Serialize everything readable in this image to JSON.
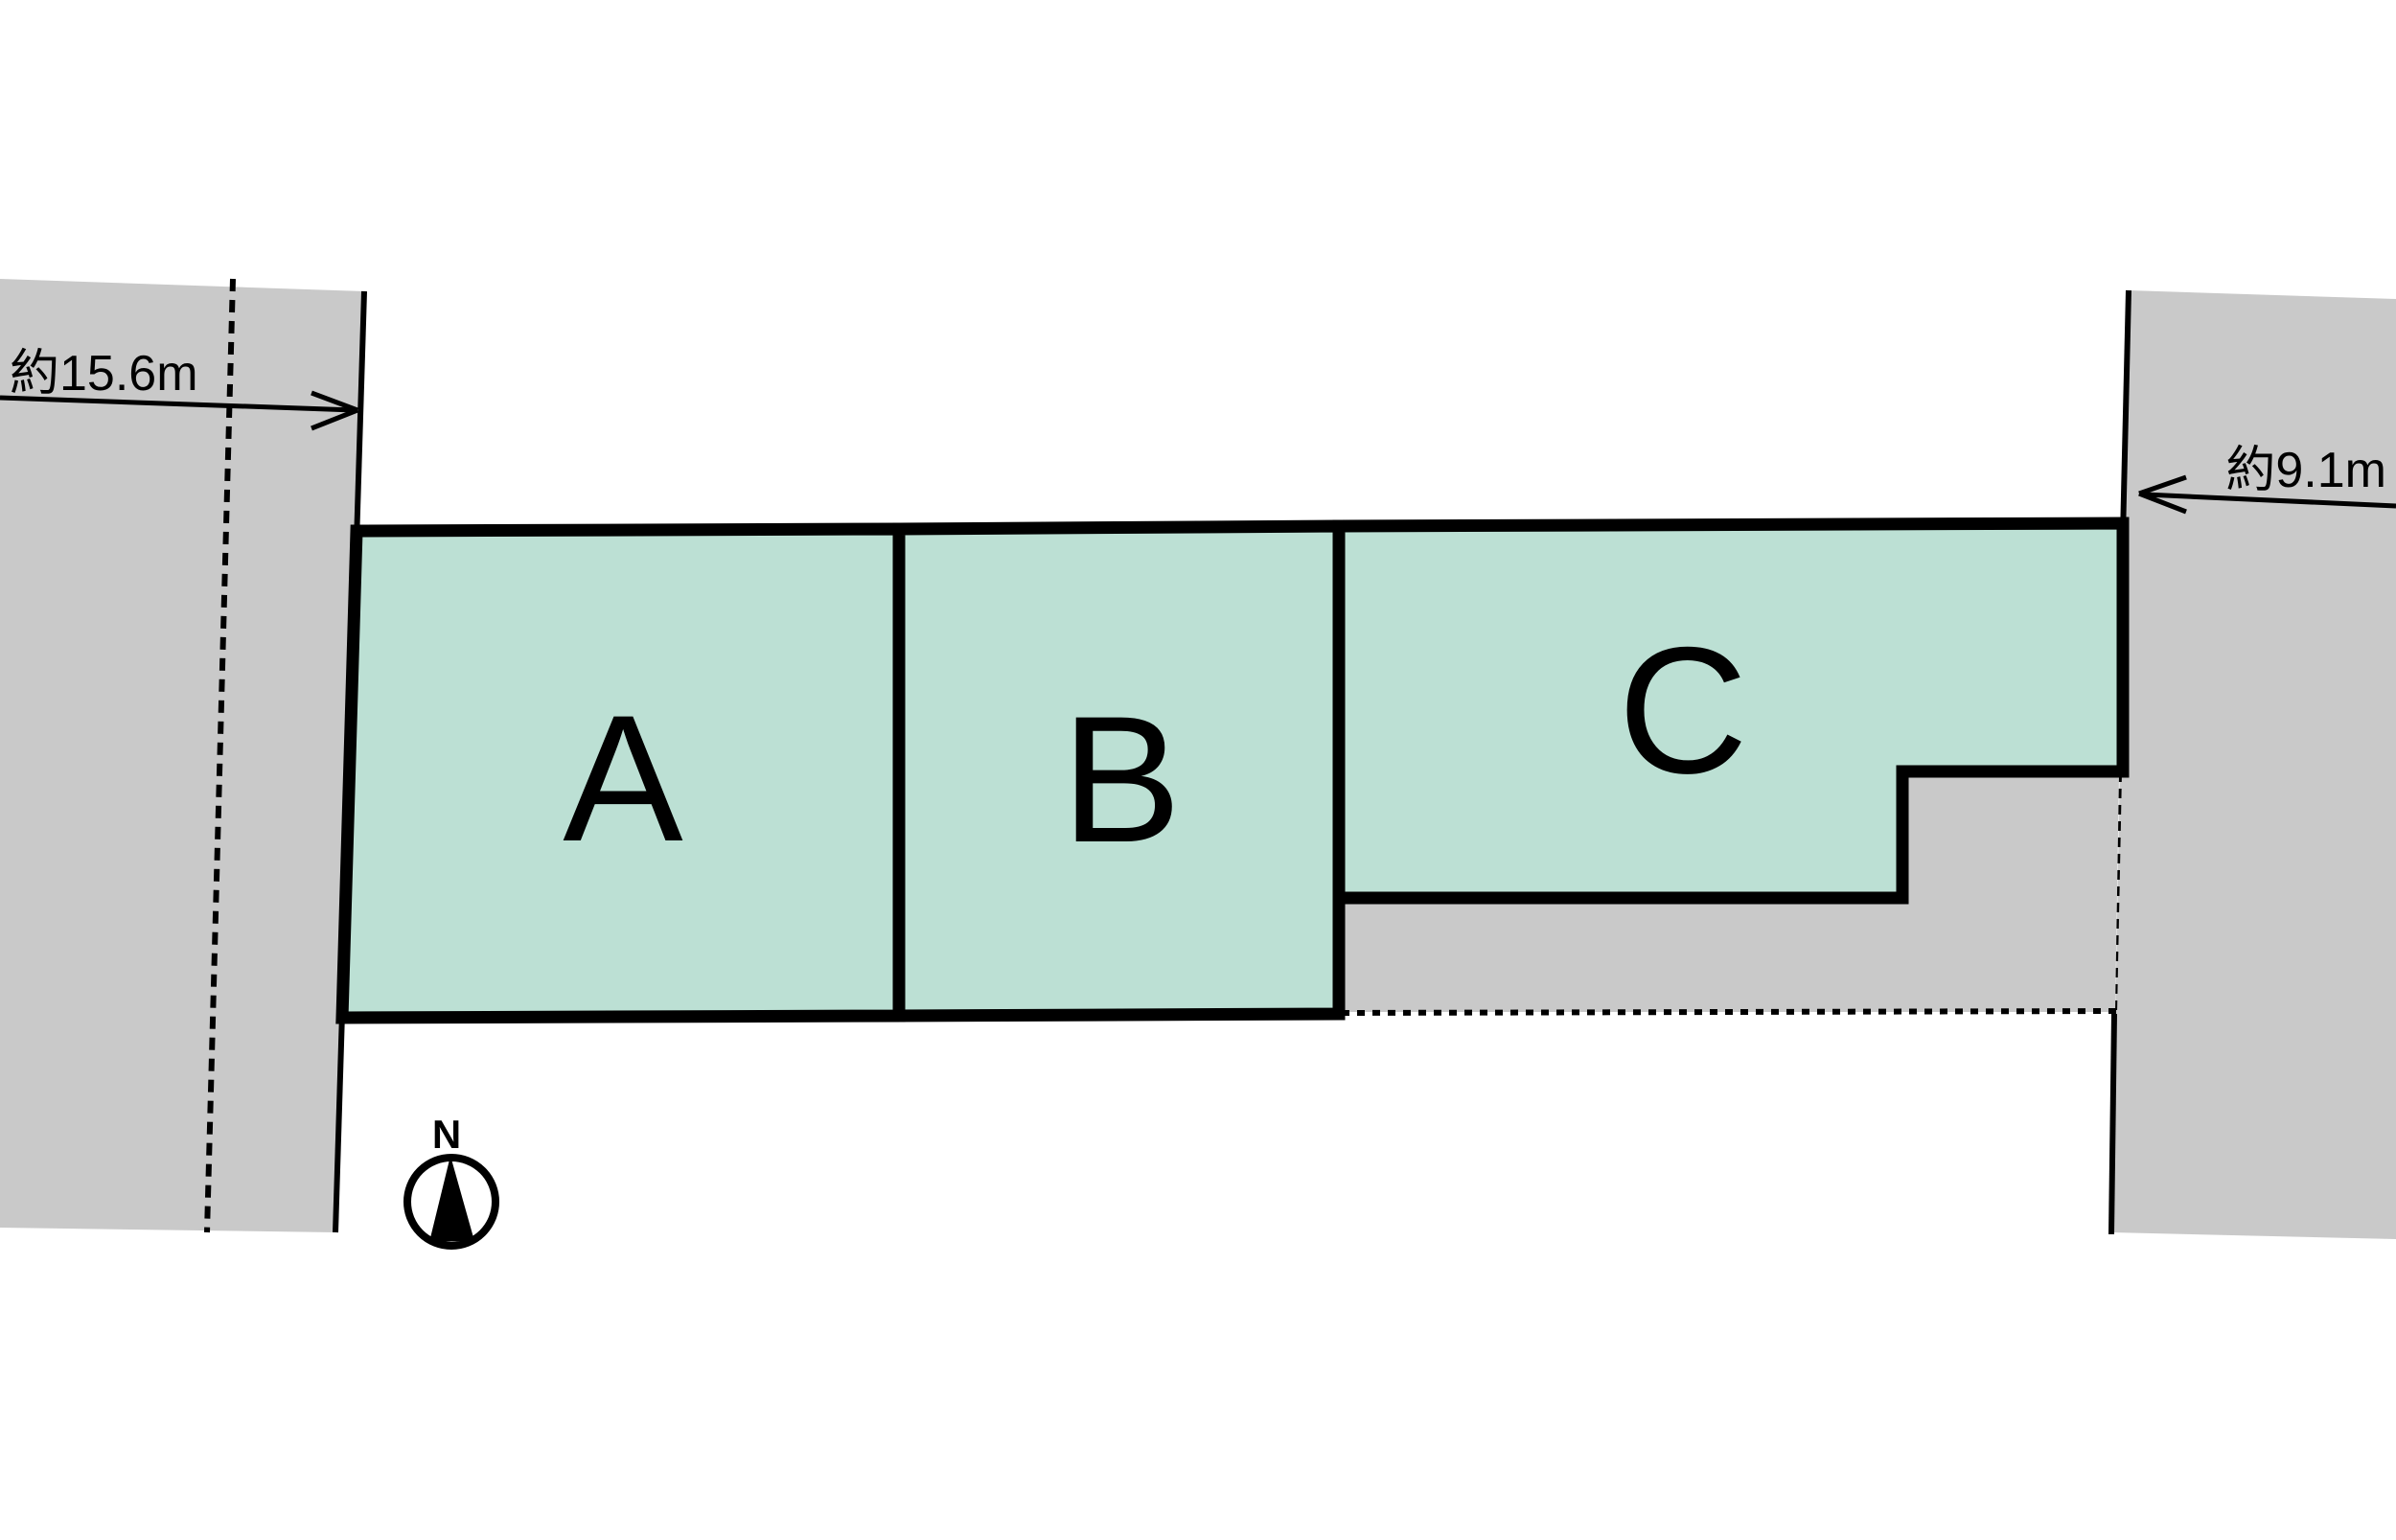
{
  "diagram": {
    "kind": "residential-lot-site-plan",
    "lots": {
      "a": {
        "label": "A"
      },
      "b": {
        "label": "B"
      },
      "c": {
        "label": "C"
      }
    },
    "dimensions": {
      "left_road_width": "約15.6m",
      "right_road_width": "約9.1m"
    },
    "compass": {
      "north_label": "N"
    }
  },
  "colors": {
    "lot_fill": "#BCE0D4",
    "road_fill": "#C9C9C9",
    "line": "#000000",
    "background": "#FFFFFF"
  }
}
